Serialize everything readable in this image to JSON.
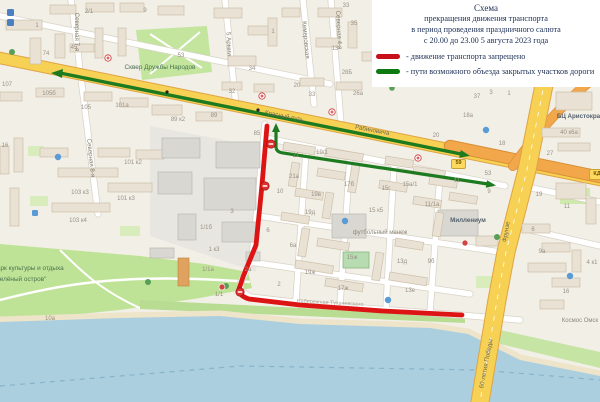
{
  "legend": {
    "title_lines": [
      "Схема",
      "прекращения движения транспорта",
      "в период проведения праздничного салюта",
      "с 20.00 до 23.00 5 августа 2023 года"
    ],
    "items": [
      {
        "label": "- движение транспорта запрещено",
        "color": "#c8101a"
      },
      {
        "label": "- пути возможного объезда закрытых участков дороги",
        "color": "#0c7a10"
      }
    ]
  },
  "map": {
    "colors": {
      "closed_route": "#dc1414",
      "detour_route": "#1d7a1f",
      "primary_road": "#f7d154",
      "secondary_road": "#f2a74b",
      "water": "#abcfdf",
      "park": "#bfe396"
    },
    "street_labels": [
      {
        "t": "Северная 7-я"
      },
      {
        "t": "Северная 4-я"
      },
      {
        "t": "Кемеровская"
      },
      {
        "t": "5 Армии"
      },
      {
        "t": "Северная 8-я"
      },
      {
        "t": "Красный путь"
      },
      {
        "t": "Рабиновича"
      },
      {
        "t": "Фрунзе"
      },
      {
        "t": "60-летия Победы"
      },
      {
        "t": "Набережная Тухачевского"
      }
    ],
    "place_labels": [
      {
        "t": "Сквер Дружбы Народов"
      },
      {
        "t": "футбольный манеж"
      },
      {
        "t": "Миллениум"
      },
      {
        "t": "БЦ Аристократ"
      },
      {
        "t": "Космос Омск"
      },
      {
        "t": "Парк культуры и отдыха"
      },
      {
        "t": "\"Зелёный остров\""
      }
    ],
    "badges": [
      {
        "t": "59"
      },
      {
        "t": "КД"
      }
    ],
    "building_labels": [
      {
        "t": "2/1"
      },
      {
        "t": "1"
      },
      {
        "t": "74"
      },
      {
        "t": "45"
      },
      {
        "t": "9"
      },
      {
        "t": "53"
      },
      {
        "t": "107"
      },
      {
        "t": "105б"
      },
      {
        "t": "105"
      },
      {
        "t": "101а"
      },
      {
        "t": "89 к2"
      },
      {
        "t": "34"
      },
      {
        "t": "32"
      },
      {
        "t": "20"
      },
      {
        "t": "33"
      },
      {
        "t": "33"
      },
      {
        "t": "35"
      },
      {
        "t": "13"
      },
      {
        "t": "1"
      },
      {
        "t": "28Б"
      },
      {
        "t": "26а"
      },
      {
        "t": "37"
      },
      {
        "t": "3"
      },
      {
        "t": "1"
      },
      {
        "t": "18а"
      },
      {
        "t": "20"
      },
      {
        "t": "18"
      },
      {
        "t": "53"
      },
      {
        "t": "27"
      },
      {
        "t": "40 к6а"
      },
      {
        "t": "19"
      },
      {
        "t": "11"
      },
      {
        "t": "15а/1"
      },
      {
        "t": "11"
      },
      {
        "t": "9"
      },
      {
        "t": "11/1а"
      },
      {
        "t": "16"
      },
      {
        "t": "101 к2"
      },
      {
        "t": "103 к3"
      },
      {
        "t": "101 к3"
      },
      {
        "t": "103 к4"
      },
      {
        "t": "10а"
      },
      {
        "t": "85"
      },
      {
        "t": "89"
      },
      {
        "t": "21"
      },
      {
        "t": "19/1"
      },
      {
        "t": "21а"
      },
      {
        "t": "10"
      },
      {
        "t": "19в"
      },
      {
        "t": "17б"
      },
      {
        "t": "15г"
      },
      {
        "t": "19д"
      },
      {
        "t": "15 к5"
      },
      {
        "t": "15ж"
      },
      {
        "t": "19ж"
      },
      {
        "t": "17ж"
      },
      {
        "t": "13е"
      },
      {
        "t": "13д"
      },
      {
        "t": "9б"
      },
      {
        "t": "2"
      },
      {
        "t": "6"
      },
      {
        "t": "3"
      },
      {
        "t": "6а"
      },
      {
        "t": "2а"
      },
      {
        "t": "1/1б"
      },
      {
        "t": "1 к3"
      },
      {
        "t": "1/1а"
      },
      {
        "t": "1/1"
      },
      {
        "t": "6"
      },
      {
        "t": "9а"
      },
      {
        "t": "16"
      },
      {
        "t": "4 к1"
      }
    ]
  }
}
